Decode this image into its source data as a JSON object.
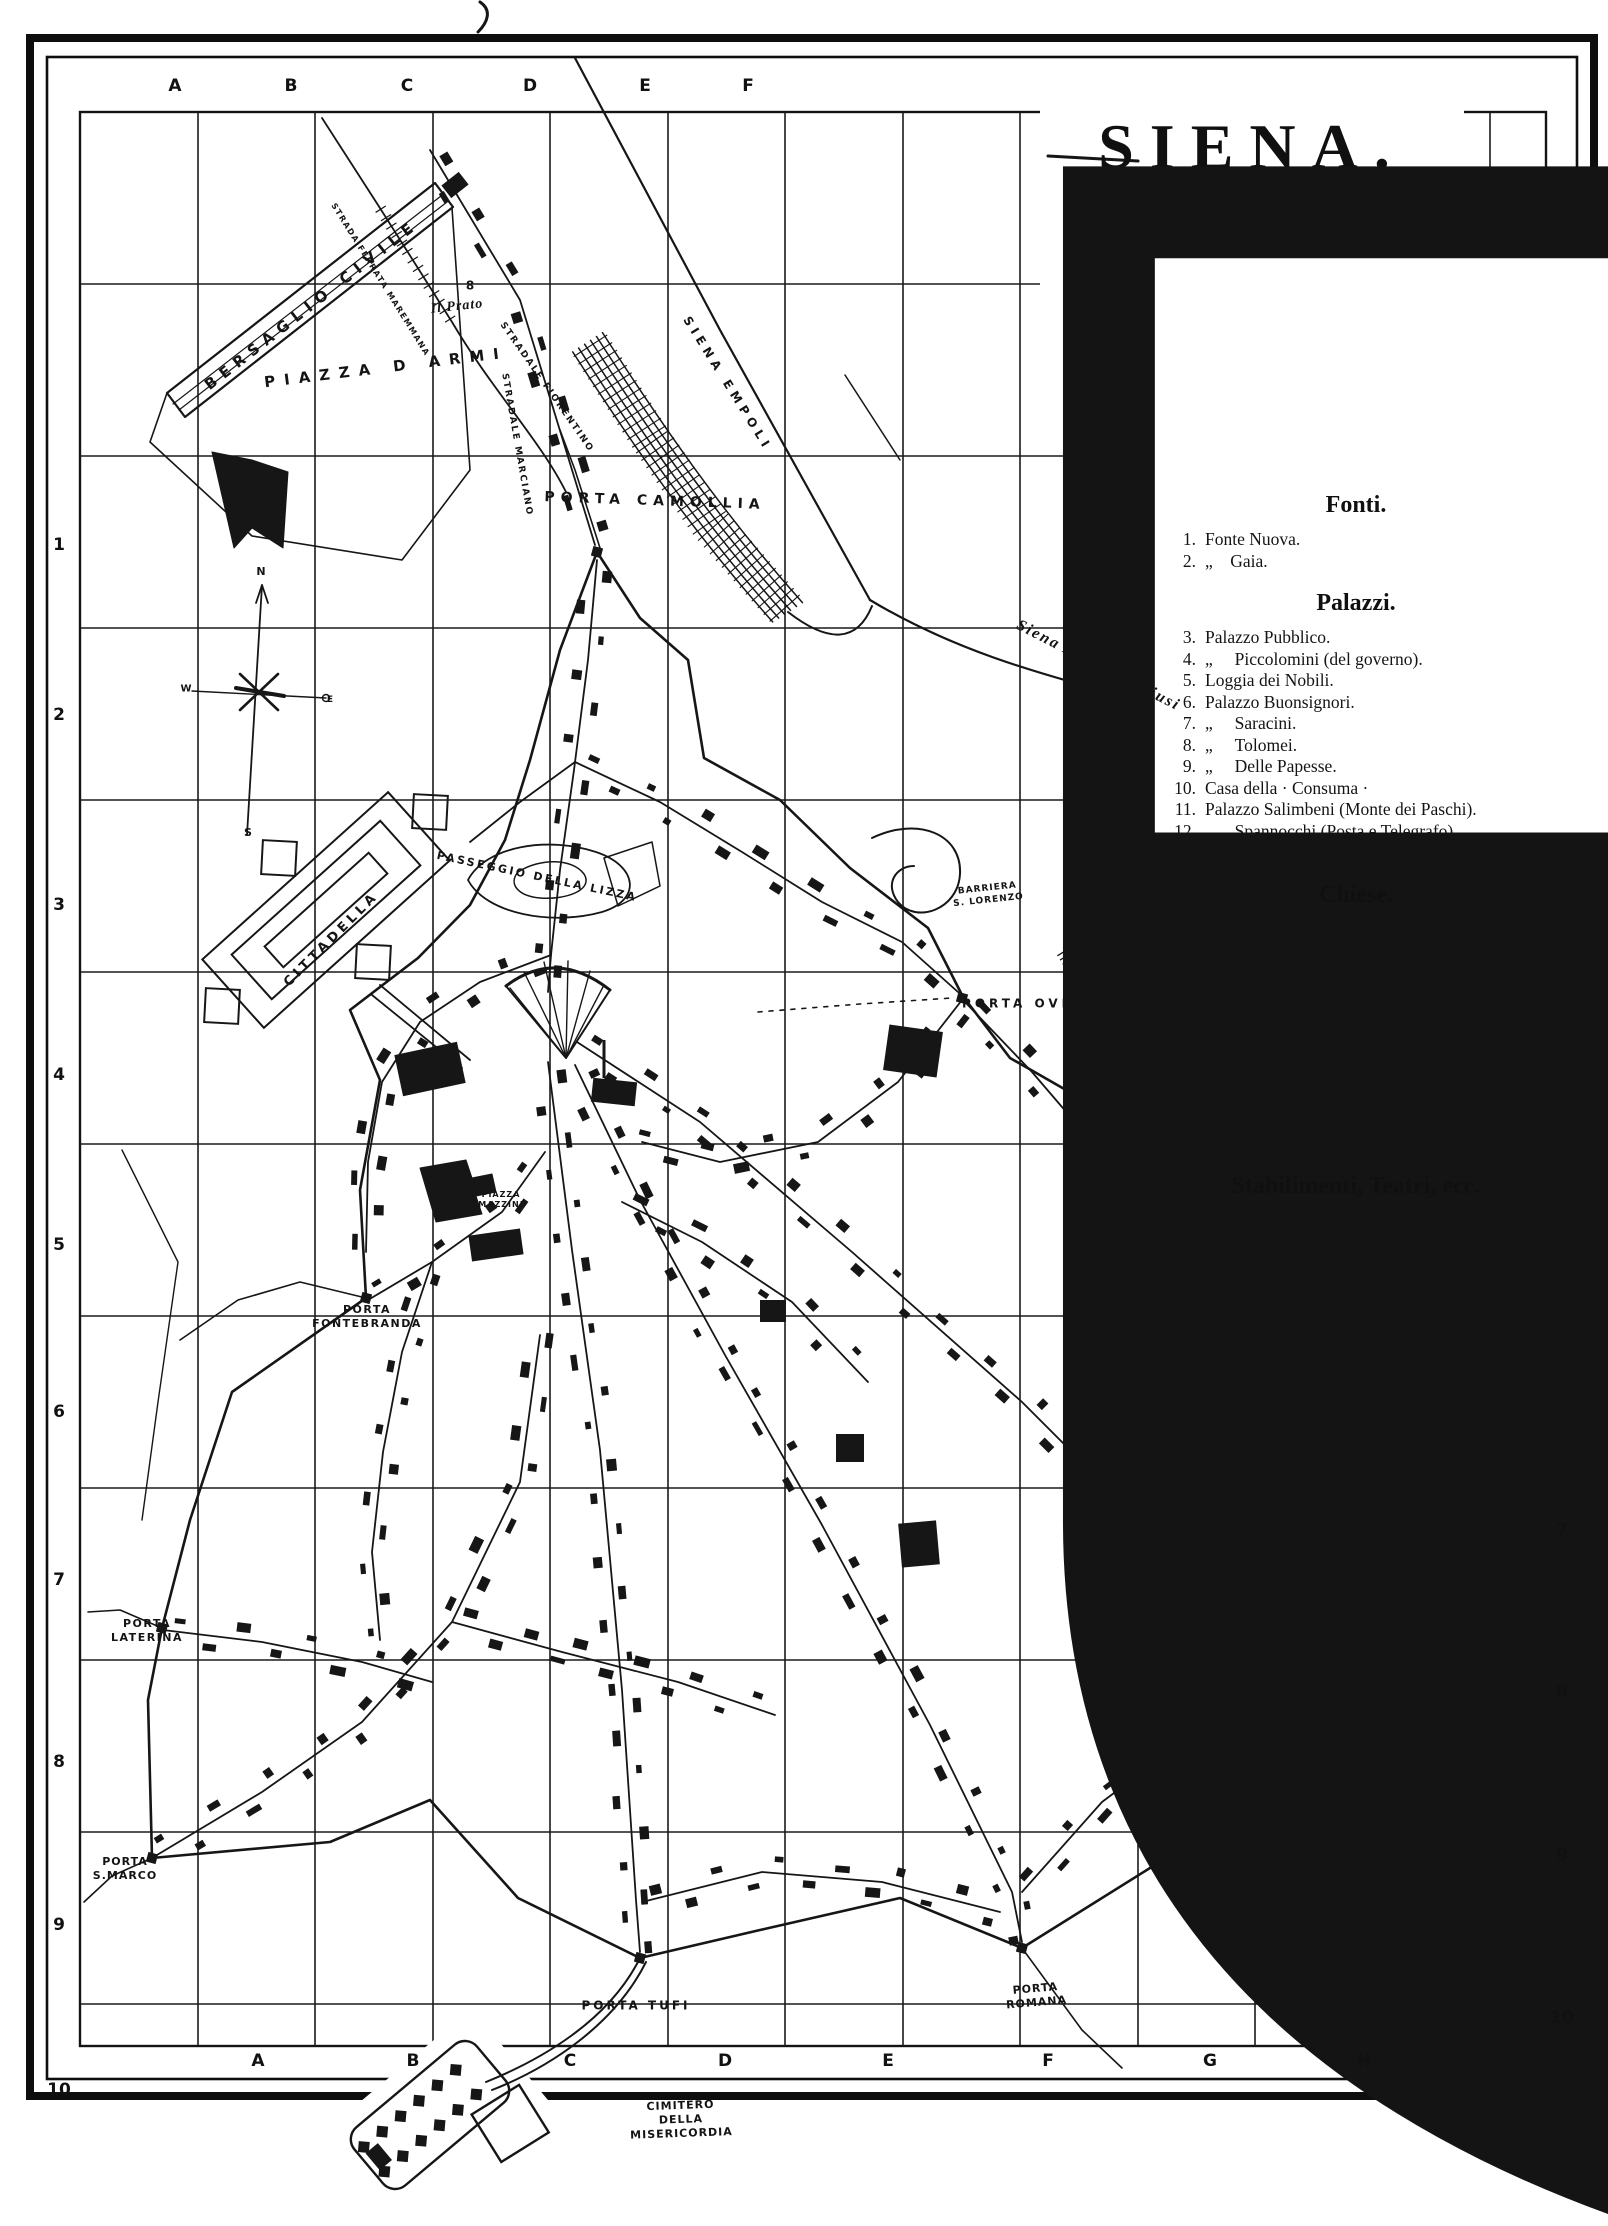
{
  "page": {
    "background": "#ffffff",
    "ink": "#161616"
  },
  "title_block": {
    "emblem": "siena-balzana-shield",
    "city": "SIENA.",
    "scale": "Scale 1 in 1700"
  },
  "legend": {
    "sections": [
      {
        "title": "Fonti.",
        "items": [
          {
            "num": "1.",
            "text": "Fonte Nuova."
          },
          {
            "num": "2.",
            "text": "„    Gaia."
          }
        ]
      },
      {
        "title": "Palazzi.",
        "items": [
          {
            "num": "3.",
            "text": "Palazzo Pubblico."
          },
          {
            "num": "4.",
            "text": "„     Piccolomini (del governo)."
          },
          {
            "num": "5.",
            "text": "Loggia dei Nobili."
          },
          {
            "num": "6.",
            "text": "Palazzo Buonsignori."
          },
          {
            "num": "7.",
            "text": "„     Saracini."
          },
          {
            "num": "8.",
            "text": "„     Tolomei."
          },
          {
            "num": "9.",
            "text": "„     Delle Papesse."
          },
          {
            "num": "10.",
            "text": "Casa della · Consuma ·"
          },
          {
            "num": "11.",
            "text": "Palazzo Salimbeni (Monte dei Paschi)."
          },
          {
            "num": "12.",
            "text": "„     Spannocchi (Posta e Telegrafo)."
          },
          {
            "num": "13.",
            "text": "„     del · Magnifico ·"
          }
        ]
      },
      {
        "title": "Chiese.",
        "items": [
          {
            "num": "14.",
            "text": "Duomo."
          },
          {
            "num": "15.",
            "text": "S. Domenico."
          },
          {
            "num": "16.",
            "text": "S. Francesco."
          },
          {
            "num": "17.",
            "text": "S. Spirito."
          },
          {
            "num": "18.",
            "text": "Chiesa dei Servi."
          },
          {
            "num": "19.",
            "text": "S. Martino."
          },
          {
            "num": "20.",
            "text": "S. Cristofano."
          },
          {
            "num": "21.",
            "text": "Oratorio di S. Caterina."
          },
          {
            "num": "22.",
            "text": "Casa di S. Caterina."
          },
          {
            "num": "23.",
            "text": "Oratorio di S. Bernardino."
          },
          {
            "num": "24.",
            "text": "Chiesa dello Spedale."
          }
        ]
      },
      {
        "title": "Stabilimenti, Teatri, ecc.",
        "items": [
          {
            "num": "25.",
            "text": "Spedale di S. M. della Scala."
          },
          {
            "num": "26.",
            "text": "Università."
          },
          {
            "num": "27.",
            "text": "Accademia di Belle Arti."
          },
          {
            "num": "28.",
            "text": "Teatro dei Rinnuovati."
          },
          {
            "num": "29.",
            "text": "Accademia e Teatro dei Rozzi."
          },
          {
            "num": "30.",
            "text": "Conservatorio di S. M. Maddalena gia del Rifugio."
          },
          {
            "num": "31.",
            "text": "Istituto Pendola pei Sordomuti."
          }
        ]
      }
    ]
  },
  "grid": {
    "top_letters": [
      "A",
      "B",
      "C",
      "D",
      "E",
      "F"
    ],
    "bottom_letters": [
      "A",
      "B",
      "C",
      "D",
      "E",
      "F",
      "G",
      "H"
    ],
    "left_numbers": [
      "1",
      "2",
      "3",
      "4",
      "5",
      "6",
      "7",
      "8",
      "9",
      "10"
    ],
    "right_numbers": [
      "7",
      "8",
      "9",
      "10"
    ]
  },
  "compass": {
    "n": "N",
    "s": "S",
    "e": "E",
    "w": "W"
  },
  "map_labels": [
    {
      "id": "bersaglio",
      "text": "BERSAGLIO CIVILE"
    },
    {
      "id": "prato",
      "text": "Il Prato"
    },
    {
      "id": "mk8",
      "text": "8"
    },
    {
      "id": "armi",
      "text": "PIAZZA D ARMI"
    },
    {
      "id": "fiorentino",
      "text": "STRADALE FIORENTINO"
    },
    {
      "id": "maremmana",
      "text": "STRADA FERRATA MAREMMANA"
    },
    {
      "id": "marciano",
      "text": "STRADALE MARCIANO"
    },
    {
      "id": "camollia",
      "text": "PORTA CAMOLLIA"
    },
    {
      "id": "empoli",
      "text": "SIENA EMPOLI"
    },
    {
      "id": "asciano",
      "text": "Siena Asciano Chiusi"
    },
    {
      "id": "lizza",
      "text": "PASSEGGIO DELLA LIZZA"
    },
    {
      "id": "cittadella",
      "text": "CITTADELLA"
    },
    {
      "id": "barriera",
      "lines": [
        "BARRIERA",
        "S. LORENZO"
      ]
    },
    {
      "id": "ovile",
      "text": "PORTA OVILE"
    },
    {
      "id": "mazzini",
      "lines": [
        "PIAZZA",
        "MAZZINI"
      ]
    },
    {
      "id": "fontebranda",
      "lines": [
        "PORTA",
        "FONTEBRANDA"
      ]
    },
    {
      "id": "laterina",
      "lines": [
        "PORTA",
        "LATERINA"
      ]
    },
    {
      "id": "smarco",
      "lines": [
        "PORTA",
        "S.MARCO"
      ]
    },
    {
      "id": "tufi",
      "text": "PORTA TUFI"
    },
    {
      "id": "romana",
      "lines": [
        "PORTA",
        "ROMANA"
      ]
    },
    {
      "id": "pispini",
      "lines": [
        "PORTA",
        "PISPINI"
      ]
    },
    {
      "id": "cimitero",
      "lines": [
        "CIMITERO",
        "DELLA",
        "MISERICORDIA"
      ]
    }
  ]
}
